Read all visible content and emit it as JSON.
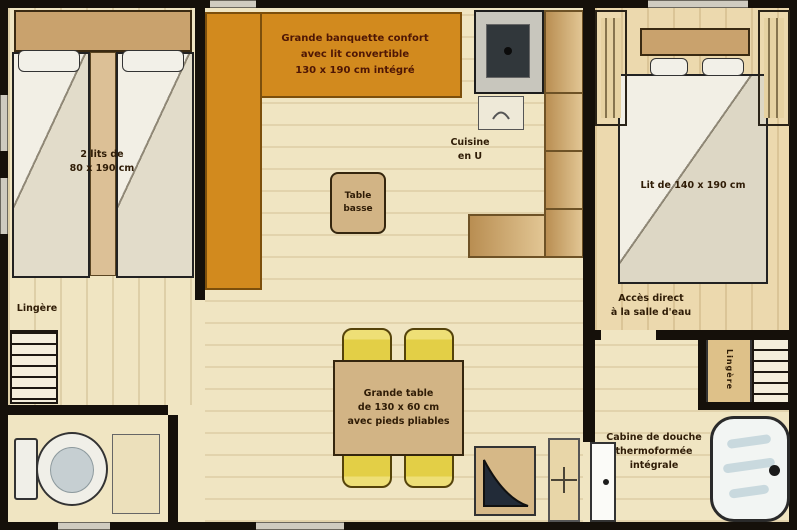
{
  "labels": {
    "twin_beds": "2 lits de\n80 x 190 cm",
    "linen_left": "Lingère",
    "banquette": "Grande banquette confort\navec lit convertible\n130 x 190 cm intégré",
    "coffee_table": "Table\nbasse",
    "kitchen": "Cuisine\nen U",
    "dining_table": "Grande table\nde 130 x 60 cm\navec pieds pliables",
    "double_bed": "Lit de 140 x 190 cm",
    "bathroom_access": "Accès direct\nà la salle d'eau",
    "linen_right": "Lingère",
    "shower": "Cabine de douche\nthermoformée\nintégrale"
  },
  "colors": {
    "wall": "#15100a",
    "floor": "#f0e5c2",
    "banquette": "#d28a1e",
    "chair": "#e3cf46",
    "stove": "#31373b",
    "shower": "#f2f5f3",
    "label_text": "#2f1c06"
  }
}
